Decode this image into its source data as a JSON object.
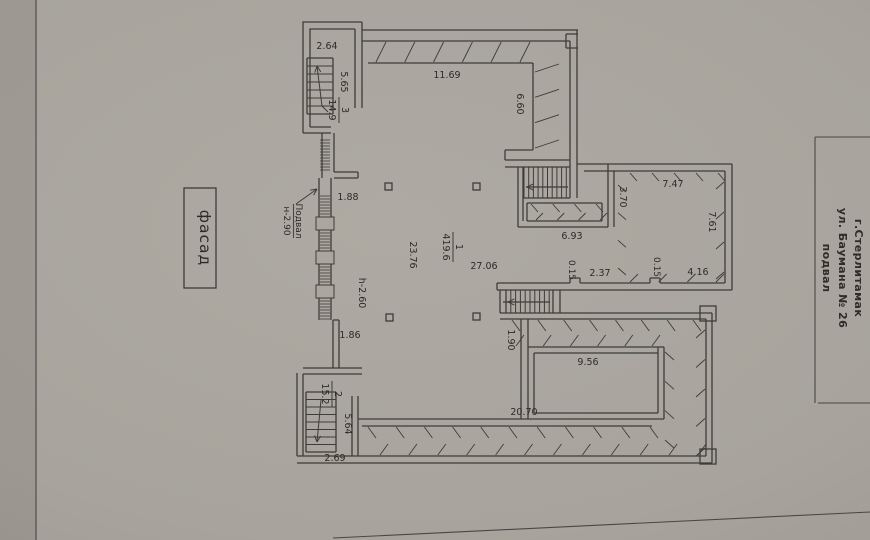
{
  "sheet": {
    "title_block": {
      "city": "г.Стерлитамак",
      "street": "ул. Баумана № 26",
      "level": "подвал"
    },
    "facade_label": "фасад",
    "callout": {
      "name": "Подвал",
      "height_mark": "н-2.90"
    }
  },
  "rooms": [
    {
      "number": "3",
      "area": "14.9"
    },
    {
      "number": "1",
      "area": "419.6"
    },
    {
      "number": "2",
      "area": "15.2"
    }
  ],
  "dims": {
    "top_block_width": "2.64",
    "top_block_height": "5.65",
    "hall_top_width": "11.69",
    "right_section_depth": "6.60",
    "jog_top": "1.88",
    "hall_depth": "23.76",
    "hall_width": "27.06",
    "mid_stairs_width": "6.93",
    "right_room_left_seg": "3.70",
    "right_room_width": "7.47",
    "right_room_height": "7.61",
    "notch_a": "0.15",
    "seg_237": "2.37",
    "notch_b": "0.15",
    "seg_416": "4.16",
    "ceiling_height": "h-2.60",
    "jog_bottom": "1.86",
    "passage": "1.90",
    "inner_room_width": "9.56",
    "hall_bottom_width": "20.70",
    "bottom_block_height": "5.64",
    "bottom_block_width": "2.69"
  }
}
